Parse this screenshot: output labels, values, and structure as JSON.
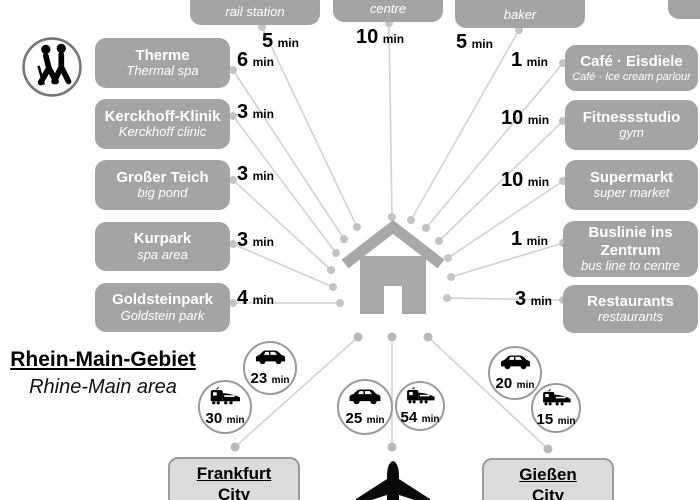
{
  "units": {
    "min": "min"
  },
  "top_items": [
    {
      "en": "rail station",
      "time": "5"
    },
    {
      "en": "centre",
      "time": "10"
    },
    {
      "en": "baker",
      "time": "5"
    }
  ],
  "left_items": [
    {
      "de": "Therme",
      "en": "Thermal spa",
      "time": "6"
    },
    {
      "de": "Kerckhoff-Klinik",
      "en": "Kerckhoff clinic",
      "time": "3"
    },
    {
      "de": "Großer Teich",
      "en": "big pond",
      "time": "3"
    },
    {
      "de": "Kurpark",
      "en": "spa area",
      "time": "3"
    },
    {
      "de": "Goldsteinpark",
      "en": "Goldstein park",
      "time": "4"
    }
  ],
  "right_items": [
    {
      "de": "Café · Eisdiele",
      "en": "Café · Ice cream parlour",
      "time": "1"
    },
    {
      "de": "Fitnessstudio",
      "en": "gym",
      "time": "10"
    },
    {
      "de": "Supermarkt",
      "en": "super market",
      "time": "10"
    },
    {
      "de": "Buslinie ins Zentrum",
      "en": "bus line to centre",
      "time": "1"
    },
    {
      "de": "Restaurants",
      "en": "restaurants",
      "time": "3"
    }
  ],
  "region": {
    "de": "Rhein-Main-Gebiet",
    "en": "Rhine-Main area"
  },
  "destinations": {
    "frankfurt": {
      "name": "Frankfurt",
      "sub": "City",
      "car_time": "23",
      "train_time": "30"
    },
    "airport": {
      "car_time": "25",
      "train_time": "54"
    },
    "giessen": {
      "name": "Gießen",
      "sub": "City",
      "car_time": "20",
      "train_time": "15"
    }
  },
  "colors": {
    "amenity_box": "#a4a4a4",
    "city_box": "#dcdcdc",
    "city_box_border": "#9b9b9b",
    "connector_line": "#d2d2d2",
    "connector_dot": "#c4c4c4",
    "house": "#a8a8a8",
    "icon_black": "#000000",
    "text_white": "#ffffff"
  }
}
